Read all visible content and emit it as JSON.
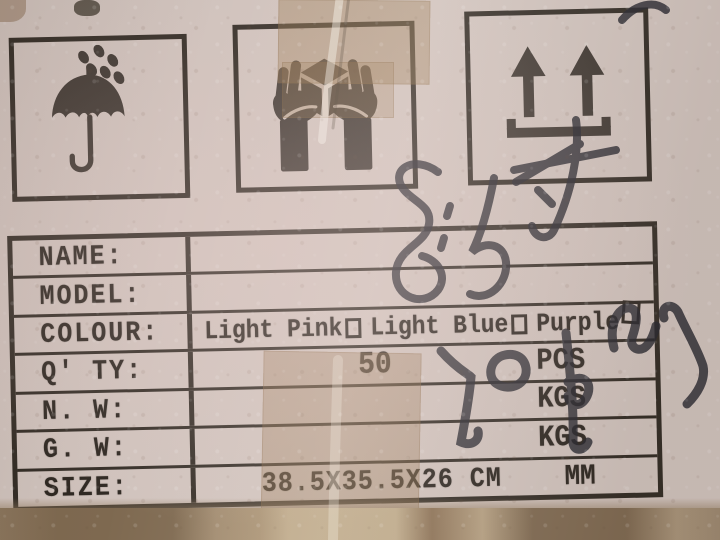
{
  "scene": {
    "description": "Photograph of a printed shipping label on a cardboard box with packing tape and marker handwriting"
  },
  "colors": {
    "cardboard": "#d0c3bd",
    "cardboard_dark_strip": "#8a755c",
    "print_ink": "#2e2822",
    "tape": "#b2946c",
    "marker": "#26262e"
  },
  "pictograms": [
    {
      "name": "keep-dry",
      "description": "umbrella with raindrops"
    },
    {
      "name": "handle-with-care",
      "description": "two hands holding a box"
    },
    {
      "name": "this-way-up",
      "description": "two arrows pointing up over a bar"
    }
  ],
  "table": {
    "rows": [
      {
        "label": "NAME:",
        "value": "",
        "unit": ""
      },
      {
        "label": "MODEL:",
        "value": "",
        "unit": ""
      },
      {
        "label": "COLOUR:",
        "value": "Light Pink□ Light Blue□ Purple□",
        "unit": ""
      },
      {
        "label": "Q' TY:",
        "value": "50",
        "unit": "PCS"
      },
      {
        "label": "N. W:",
        "value": "",
        "unit": "KGS"
      },
      {
        "label": "G. W:",
        "value": "",
        "unit": "KGS"
      },
      {
        "label": "SIZE:",
        "value": "38.5X35.5X26 CM",
        "unit": "MM"
      }
    ],
    "colour_options": [
      {
        "label": "Light Pink",
        "checked": false
      },
      {
        "label": "Light Blue",
        "checked": false
      },
      {
        "label": "Purple",
        "checked": false
      }
    ]
  },
  "handwriting": {
    "top_annotation": "8.5寸",
    "qty_annotation": "50pcs",
    "color": "#26262e"
  }
}
